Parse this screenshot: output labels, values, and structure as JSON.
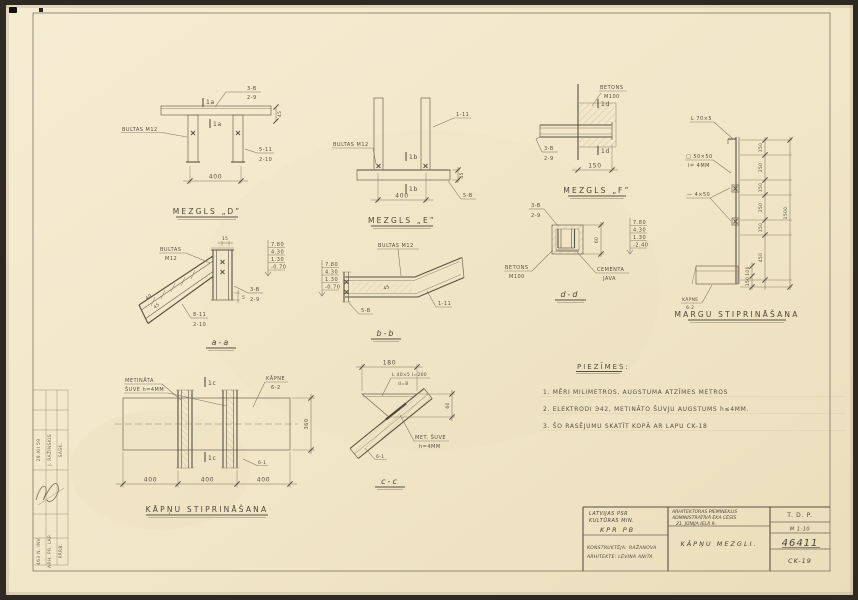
{
  "colors": {
    "paper": "#f2e7cb",
    "pencil": "#6e6655",
    "dark_edge": "#2e2a23"
  },
  "mezgls_d": {
    "title": "MEZGLS „D”",
    "bolts": "BULTAS M12",
    "ref_top_a": "3-B",
    "ref_top_b": "2-9",
    "mark": "1a",
    "ref_right_a": "5-11",
    "ref_right_b": "2-10",
    "dim": "400",
    "dim_side": "45"
  },
  "mezgls_e": {
    "title": "MEZGLS „E”",
    "bolts": "BULTAS M12",
    "ref_right": "1-11",
    "mark": "1b",
    "ref_base": "5-B",
    "dim": "400",
    "dim_side": "45"
  },
  "mezgls_f": {
    "title": "MEZGLS „F”",
    "concrete_a": "BETONS",
    "concrete_b": "M100",
    "mark": "1d",
    "ref_a": "3-B",
    "ref_b": "2-9",
    "dim": "150"
  },
  "railing": {
    "title": "MARGU STIPRINĀŠANA",
    "angle": "L 70×5",
    "plate_a": "□ 50×50",
    "plate_b": "l= 4MM",
    "strip": "— 4×50",
    "stair_a": "KĀPNE",
    "stair_b": "6-2",
    "dims": [
      "150",
      "250",
      "150",
      "250",
      "150",
      "450"
    ],
    "dims_small": [
      "100",
      "150"
    ],
    "total": "1500"
  },
  "sec_aa": {
    "title": "a-a",
    "bolts_a": "BULTAS",
    "bolts_b": "M12",
    "ref1_a": "3-B",
    "ref1_b": "2-9",
    "ref2_a": "8-11",
    "ref2_b": "2-10",
    "dim_top": "15",
    "dim_i1": "40",
    "dim_i2": "45",
    "dim_b": "5",
    "elev": [
      "7.80",
      "4.30",
      "1.30",
      "-0.70"
    ]
  },
  "sec_bb": {
    "title": "b-b",
    "bolts": "BULTAS M12",
    "ref": "1-11",
    "plate": "5-B",
    "dim": "45",
    "elev": [
      "7.80",
      "4.30",
      "1.30",
      "-0.70"
    ]
  },
  "sec_dd": {
    "title": "d-d",
    "ref_a": "3-B",
    "ref_b": "2-9",
    "concrete_a": "BETONS",
    "concrete_b": "M100",
    "mortar_a": "CEMENTA",
    "mortar_b": "JAVA",
    "dim": "60",
    "elev": [
      "7.80",
      "4.30",
      "1.30",
      "-2.40"
    ]
  },
  "plan": {
    "title": "KĀPŅU STIPRINĀŠANA",
    "weld_a": "METINĀTA",
    "weld_b": "ŠUVE h=4MM",
    "stair_a": "KĀPNE",
    "stair_b": "6-2",
    "mark": "1c",
    "dim_v": "360",
    "dims": [
      "400",
      "400",
      "400"
    ],
    "ref": "6-1"
  },
  "sec_cc": {
    "title": "c-c",
    "dim_top": "180",
    "angle_a": "L 40×5 l=200",
    "angle_b": "d=8",
    "dim_r": "60",
    "weld_a": "MET. ŠUVE",
    "weld_b": "h=4MM",
    "ref": "6-1"
  },
  "notes": {
    "title": "PIEZĪMES:",
    "items": [
      "1. MĒRI MILIMETROS, AUGSTUMA ATZĪMES METROS",
      "2. ELEKTRODI Э42, METINĀTO ŠUVJU AUGSTUMS h≤4MM.",
      "3. ŠO RASĒJUMU SKATĪT KOPĀ AR LAPU CK-18"
    ]
  },
  "title_block": {
    "org_1": "LATVIJAS PSR",
    "org_2": "KULTŪRAS MIN.",
    "org_3": "KPR PB",
    "author_1": "KONSTRUKTĒJA: RAŽANOVA",
    "author_2": "ARHITEKTE: LĒVINA ANITA",
    "project_1": "ARHITEKTŪRAS PIEMINEKLIS",
    "project_2": "ADMINISTRATĪVĀ ĒKA CĒSĪS",
    "project_3": "21. JŪNIJA IELĀ 9.",
    "drawing_title": "KĀPŅU MEZGLI.",
    "stage": "T. D. P.",
    "scale": "M 1:10",
    "number": "46411",
    "sheet": "CK-19"
  },
  "stamp": {
    "rows": [
      "28.XII 59",
      "J. RAŽINSKIS",
      "SASK.",
      "463 N. INV.",
      "ARH. PR. LAP.",
      "PĀRB."
    ]
  }
}
